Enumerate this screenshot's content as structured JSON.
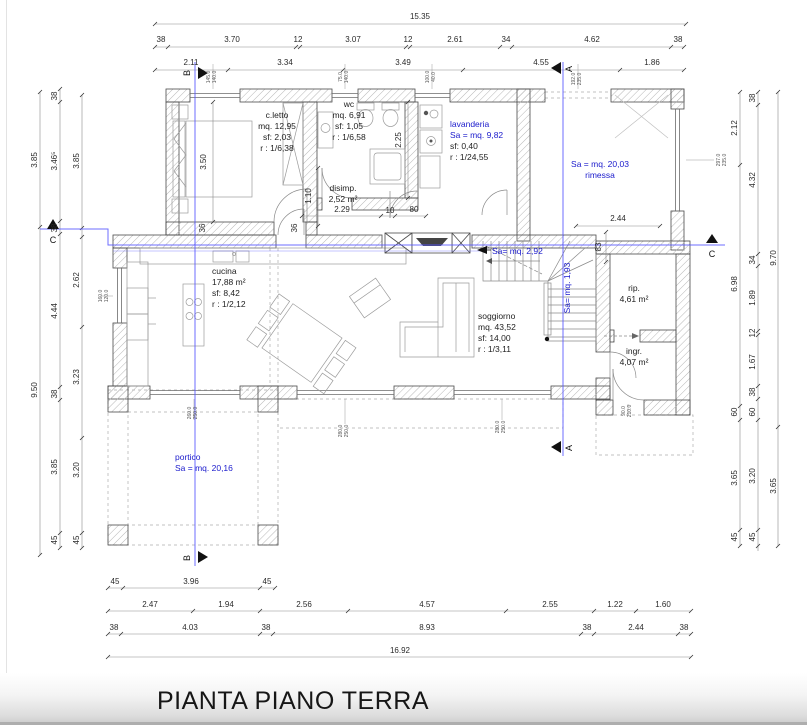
{
  "title": "PIANTA PIANO TERRA",
  "colors": {
    "blue_text": "#1a1acc",
    "blue_line": "#5555ff",
    "dim_text": "#2a2a2a"
  },
  "rooms": [
    {
      "x": 277,
      "y": 118,
      "a": "m",
      "lines": [
        {
          "t": "c.letto",
          "c": "k"
        },
        {
          "t": "mq. 12,95",
          "c": "k"
        },
        {
          "t": "sf: 2,03",
          "c": "k"
        },
        {
          "t": "r : 1/6,38",
          "c": "k"
        }
      ]
    },
    {
      "x": 349,
      "y": 107,
      "a": "m",
      "lines": [
        {
          "t": "wc",
          "c": "k"
        },
        {
          "t": "mq. 6,91",
          "c": "k"
        },
        {
          "t": "sf: 1,05",
          "c": "k"
        },
        {
          "t": "r : 1/6,58",
          "c": "k"
        }
      ]
    },
    {
      "x": 450,
      "y": 127,
      "a": "l",
      "lines": [
        {
          "t": "lavanderia",
          "c": "b"
        },
        {
          "t": "Sa = mq. 9,82",
          "c": "b"
        },
        {
          "t": "sf: 0,40",
          "c": "k"
        },
        {
          "t": "r : 1/24,55",
          "c": "k"
        }
      ]
    },
    {
      "x": 600,
      "y": 167,
      "a": "m",
      "lines": [
        {
          "t": "Sa = mq. 20,03",
          "c": "b"
        },
        {
          "t": "rimessa",
          "c": "b"
        }
      ]
    },
    {
      "x": 343,
      "y": 191,
      "a": "m",
      "lines": [
        {
          "t": "disimp.",
          "c": "k"
        },
        {
          "t": "2,52 m²",
          "c": "k"
        }
      ]
    },
    {
      "x": 212,
      "y": 274,
      "a": "l",
      "lines": [
        {
          "t": "cucina",
          "c": "k"
        },
        {
          "t": "17,88 m²",
          "c": "k"
        },
        {
          "t": "sf: 8,42",
          "c": "k"
        },
        {
          "t": "r : 1/2,12",
          "c": "k"
        }
      ]
    },
    {
      "x": 478,
      "y": 319,
      "a": "l",
      "lines": [
        {
          "t": "soggiorno",
          "c": "k"
        },
        {
          "t": "mq. 43,52",
          "c": "k"
        },
        {
          "t": "sf: 14,00",
          "c": "k"
        },
        {
          "t": "r : 1/3,11",
          "c": "k"
        }
      ]
    },
    {
      "x": 634,
      "y": 291,
      "a": "m",
      "lines": [
        {
          "t": "rip.",
          "c": "k"
        },
        {
          "t": "4,61 m²",
          "c": "k"
        }
      ]
    },
    {
      "x": 634,
      "y": 354,
      "a": "m",
      "lines": [
        {
          "t": "ingr.",
          "c": "k"
        },
        {
          "t": "4,07 m²",
          "c": "k"
        }
      ]
    },
    {
      "x": 175,
      "y": 460,
      "a": "l",
      "lines": [
        {
          "t": "portico",
          "c": "b"
        },
        {
          "t": "Sa = mq. 20,16",
          "c": "b"
        }
      ]
    }
  ],
  "blue_notes": [
    {
      "x": 492,
      "y": 254,
      "t": "Sa= mq. 2,92",
      "a": "l"
    },
    {
      "x": 570,
      "y": 288,
      "t": "Sa= mq. 1,93",
      "r": 1,
      "a": "m"
    }
  ],
  "dimensions": [
    {
      "x": 420,
      "y": 19,
      "t": "15.35"
    },
    {
      "x": 161,
      "y": 42,
      "t": "38"
    },
    {
      "x": 232,
      "y": 42,
      "t": "3.70"
    },
    {
      "x": 298,
      "y": 42,
      "t": "12"
    },
    {
      "x": 353,
      "y": 42,
      "t": "3.07"
    },
    {
      "x": 408,
      "y": 42,
      "t": "12"
    },
    {
      "x": 455,
      "y": 42,
      "t": "2.61"
    },
    {
      "x": 506,
      "y": 42,
      "t": "34"
    },
    {
      "x": 592,
      "y": 42,
      "t": "4.62"
    },
    {
      "x": 678,
      "y": 42,
      "t": "38"
    },
    {
      "x": 191,
      "y": 65,
      "t": "2.11"
    },
    {
      "x": 285,
      "y": 65,
      "t": "3.34"
    },
    {
      "x": 403,
      "y": 65,
      "t": "3.49"
    },
    {
      "x": 541,
      "y": 65,
      "t": "4.55"
    },
    {
      "x": 652,
      "y": 65,
      "t": "1.86"
    },
    {
      "x": 37,
      "y": 160,
      "t": "3.85",
      "r": 1
    },
    {
      "x": 37,
      "y": 390,
      "t": "9.50",
      "r": 1
    },
    {
      "x": 57,
      "y": 96,
      "t": "38",
      "r": 1
    },
    {
      "x": 57,
      "y": 161,
      "t": "3.46⁵",
      "r": 1
    },
    {
      "x": 57,
      "y": 228,
      "t": "38",
      "r": 1
    },
    {
      "x": 57,
      "y": 311,
      "t": "4.44",
      "r": 1
    },
    {
      "x": 57,
      "y": 394,
      "t": "38",
      "r": 1
    },
    {
      "x": 57,
      "y": 467,
      "t": "3.85",
      "r": 1
    },
    {
      "x": 57,
      "y": 540,
      "t": "45",
      "r": 1
    },
    {
      "x": 79,
      "y": 161,
      "t": "3.85",
      "r": 1
    },
    {
      "x": 79,
      "y": 280,
      "t": "2.62",
      "r": 1
    },
    {
      "x": 79,
      "y": 377,
      "t": "3.23",
      "r": 1
    },
    {
      "x": 79,
      "y": 470,
      "t": "3.20",
      "r": 1
    },
    {
      "x": 79,
      "y": 540,
      "t": "45",
      "r": 1
    },
    {
      "x": 737,
      "y": 128,
      "t": "2.12",
      "r": 1
    },
    {
      "x": 737,
      "y": 284,
      "t": "6.98",
      "r": 1
    },
    {
      "x": 737,
      "y": 412,
      "t": "60",
      "r": 1
    },
    {
      "x": 737,
      "y": 478,
      "t": "3.65",
      "r": 1
    },
    {
      "x": 737,
      "y": 537,
      "t": "45",
      "r": 1
    },
    {
      "x": 755,
      "y": 98,
      "t": "38",
      "r": 1
    },
    {
      "x": 755,
      "y": 180,
      "t": "4.32",
      "r": 1
    },
    {
      "x": 755,
      "y": 260,
      "t": "34",
      "r": 1
    },
    {
      "x": 755,
      "y": 298,
      "t": "1.89",
      "r": 1
    },
    {
      "x": 755,
      "y": 333,
      "t": "12",
      "r": 1
    },
    {
      "x": 755,
      "y": 362,
      "t": "1.67",
      "r": 1
    },
    {
      "x": 755,
      "y": 392,
      "t": "38",
      "r": 1
    },
    {
      "x": 755,
      "y": 412,
      "t": "60",
      "r": 1
    },
    {
      "x": 755,
      "y": 476,
      "t": "3.20",
      "r": 1
    },
    {
      "x": 755,
      "y": 537,
      "t": "45",
      "r": 1
    },
    {
      "x": 776,
      "y": 258,
      "t": "9.70",
      "r": 1
    },
    {
      "x": 776,
      "y": 486,
      "t": "3.65",
      "r": 1
    },
    {
      "x": 115,
      "y": 584,
      "t": "45"
    },
    {
      "x": 191,
      "y": 584,
      "t": "3.96"
    },
    {
      "x": 267,
      "y": 584,
      "t": "45"
    },
    {
      "x": 150,
      "y": 607,
      "t": "2.47"
    },
    {
      "x": 226,
      "y": 607,
      "t": "1.94"
    },
    {
      "x": 304,
      "y": 607,
      "t": "2.56"
    },
    {
      "x": 427,
      "y": 607,
      "t": "4.57"
    },
    {
      "x": 550,
      "y": 607,
      "t": "2.55"
    },
    {
      "x": 615,
      "y": 607,
      "t": "1.22"
    },
    {
      "x": 663,
      "y": 607,
      "t": "1.60"
    },
    {
      "x": 114,
      "y": 630,
      "t": "38"
    },
    {
      "x": 190,
      "y": 630,
      "t": "4.03"
    },
    {
      "x": 266,
      "y": 630,
      "t": "38"
    },
    {
      "x": 427,
      "y": 630,
      "t": "8.93"
    },
    {
      "x": 587,
      "y": 630,
      "t": "38"
    },
    {
      "x": 636,
      "y": 630,
      "t": "2.44"
    },
    {
      "x": 684,
      "y": 630,
      "t": "38"
    },
    {
      "x": 400,
      "y": 653,
      "t": "16.92"
    },
    {
      "x": 206,
      "y": 162,
      "t": "3.50",
      "r": 1
    },
    {
      "x": 401,
      "y": 140,
      "t": "2.25",
      "r": 1
    },
    {
      "x": 311,
      "y": 196,
      "t": "1.10",
      "r": 1
    },
    {
      "x": 342,
      "y": 212,
      "t": "2.29"
    },
    {
      "x": 390,
      "y": 213,
      "t": "10"
    },
    {
      "x": 414,
      "y": 212,
      "t": "80"
    },
    {
      "x": 205,
      "y": 228,
      "t": "36",
      "r": 1
    },
    {
      "x": 297,
      "y": 228,
      "t": "36",
      "r": 1
    },
    {
      "x": 618,
      "y": 221,
      "t": "2.44"
    },
    {
      "x": 601,
      "y": 247,
      "t": "83",
      "r": 1
    }
  ],
  "window_labels": [
    {
      "x": 213,
      "y": 77,
      "t": "145.0/140.0"
    },
    {
      "x": 345,
      "y": 77,
      "t": "75.0/140.0"
    },
    {
      "x": 432,
      "y": 77,
      "t": "100.0/40.0"
    },
    {
      "x": 578,
      "y": 79,
      "t": "192.0/235.0"
    },
    {
      "x": 723,
      "y": 160,
      "t": "297.0/235.0"
    },
    {
      "x": 105,
      "y": 296,
      "t": "160.0/120.0"
    },
    {
      "x": 194,
      "y": 413,
      "t": "260.0/250.0"
    },
    {
      "x": 345,
      "y": 431,
      "t": "280.0/250.0"
    },
    {
      "x": 502,
      "y": 427,
      "t": "280.0/250.0"
    },
    {
      "x": 628,
      "y": 411,
      "t": "90.0/210.0"
    }
  ],
  "section_markers": [
    {
      "x": 190,
      "y": 73,
      "t": "B",
      "r": 1
    },
    {
      "x": 190,
      "y": 558,
      "t": "B",
      "r": 1
    },
    {
      "x": 572,
      "y": 69,
      "t": "A",
      "r": 1
    },
    {
      "x": 572,
      "y": 448,
      "t": "A",
      "r": 1
    },
    {
      "x": 53,
      "y": 243,
      "t": "C"
    },
    {
      "x": 712,
      "y": 257,
      "t": "C"
    }
  ]
}
